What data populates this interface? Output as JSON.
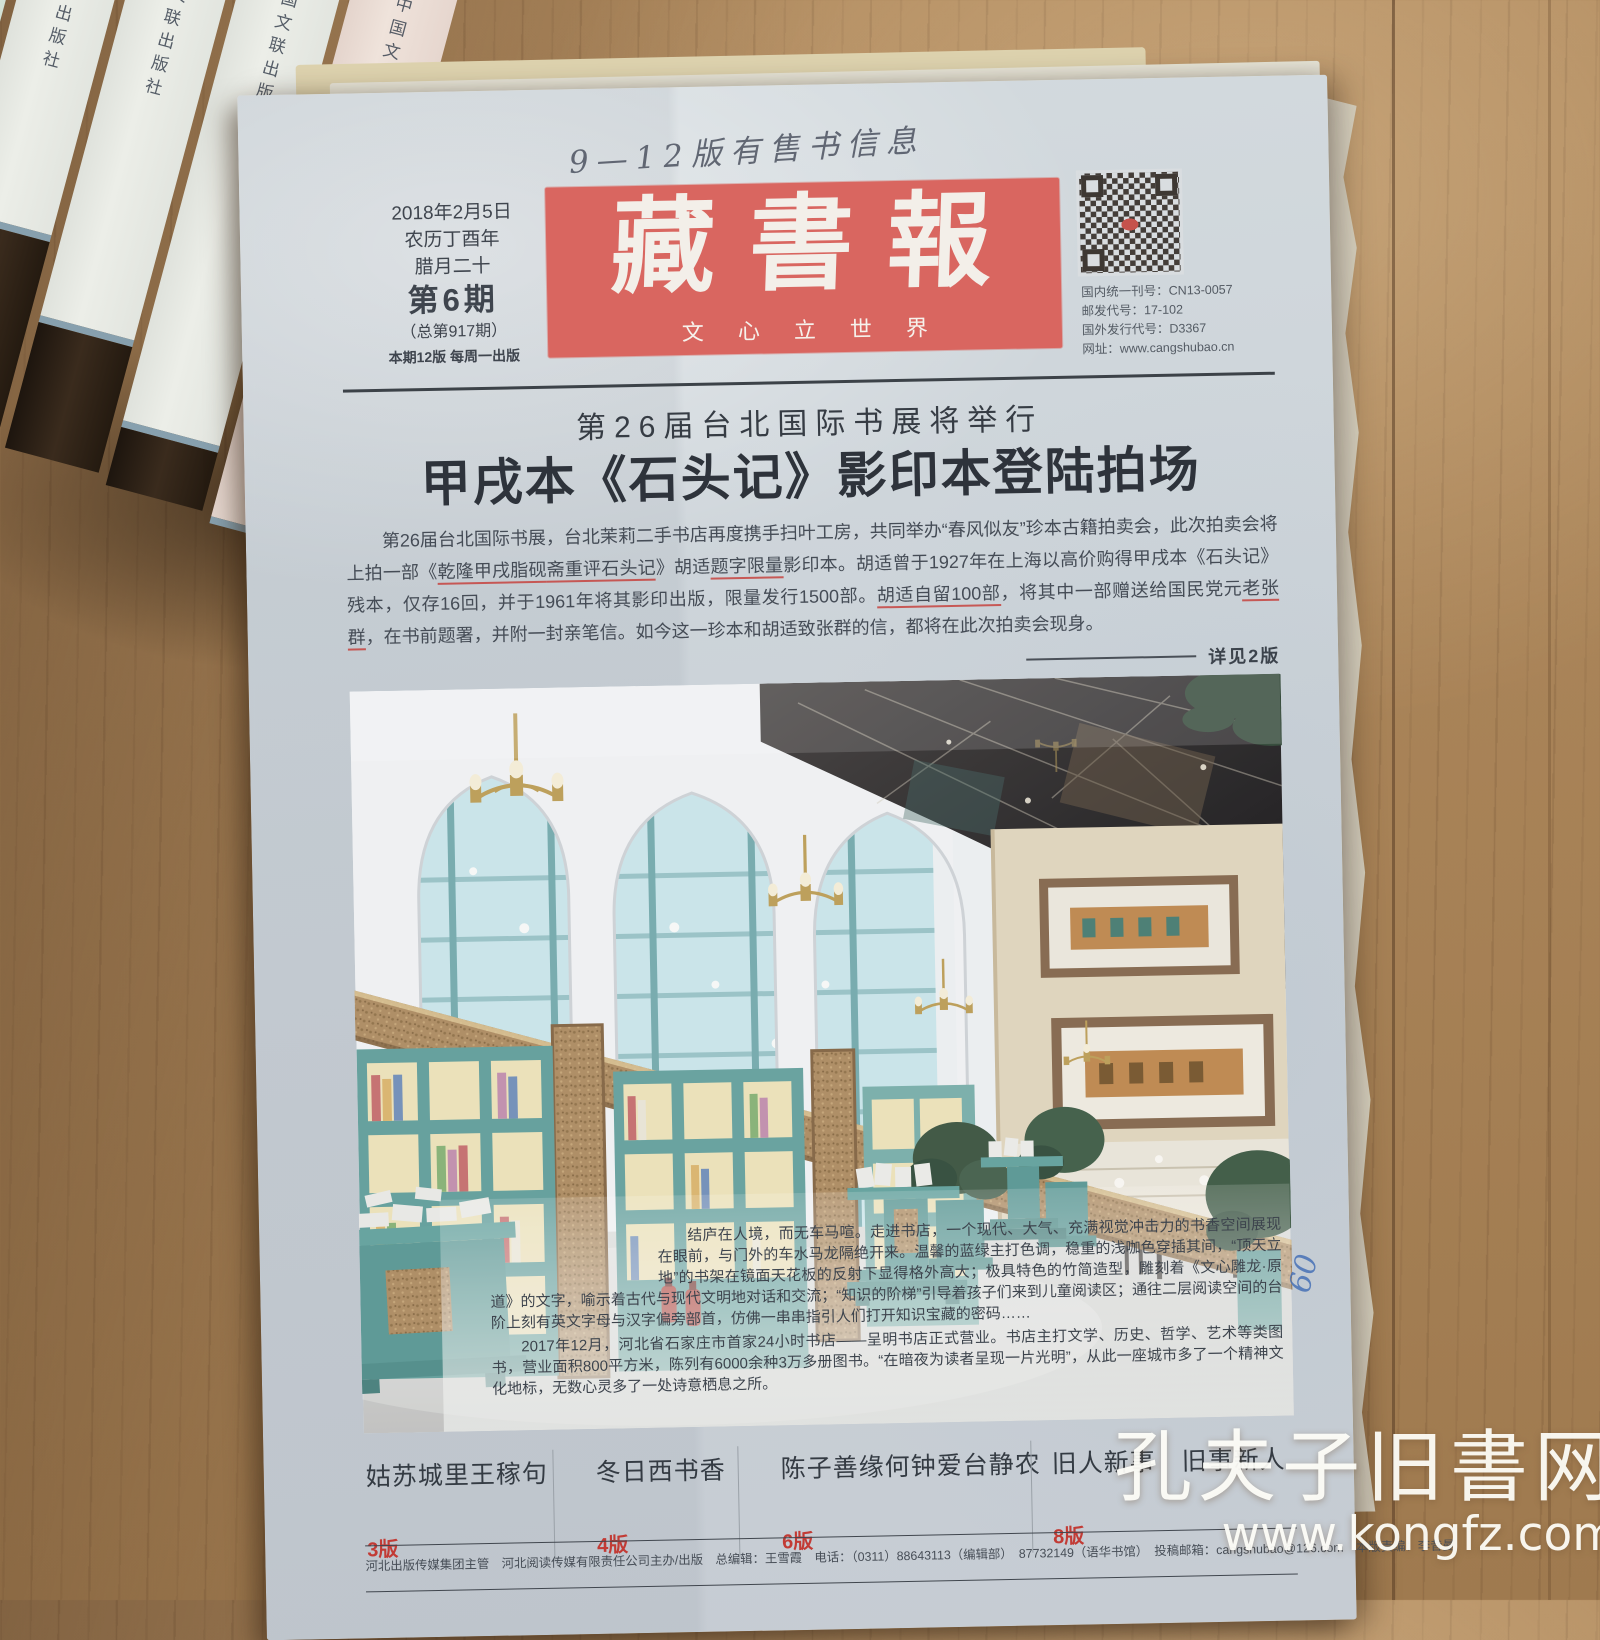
{
  "scene": {
    "hand_note": "9—12版有售书信息",
    "margin_note": "09",
    "book_spine_text": "中国文联出版社",
    "watermark": {
      "line1": "孔夫子旧書网",
      "line2": "www.kongfz.com"
    }
  },
  "masthead": {
    "title": "藏書報",
    "tagline": "文心立世界",
    "banner_color": "#d96660"
  },
  "issue_info": {
    "date": "2018年2月5日",
    "lunar_year": "农历丁酉年",
    "lunar_day": "腊月二十",
    "issue_no": "第6期",
    "total_issue": "（总第917期）",
    "pages_note": "本期12版  每周一出版"
  },
  "pub_codes": {
    "domestic": "国内统一刊号：CN13-0057",
    "postal": "邮发代号：17-102",
    "foreign": "国外发行代号：D3367",
    "website": "网址：www.cangshubao.cn"
  },
  "lead_story": {
    "kicker": "第26届台北国际书展将举行",
    "headline": "甲戌本《石头记》影印本登陆拍场",
    "body": "第26届台北国际书展，台北茉莉二手书店再度携手扫叶工房，共同举办“春风似友”珍本古籍拍卖会，此次拍卖会将上拍一部《乾隆甲戌脂砚斋重评石头记》胡适题字限量影印本。胡适曾于1927年在上海以高价购得甲戌本《石头记》残本，仅存16回，并于1961年将其影印出版，限量发行1500部。胡适自留100部，将其中一部赠送给国民党元老张群，在书前题署，并附一封亲笔信。如今这一珍本和胡适致张群的信，都将在此次拍卖会现身。",
    "red_marks": [
      "乾隆甲戌脂砚",
      "斋重评石头记",
      "题字限量",
      "胡适自留100部",
      "老张群"
    ],
    "see_more": "详见2版"
  },
  "photo_caption": {
    "para1": "结庐在人境，而无车马喧。走进书店，一个现代、大气、充满视觉冲击力的书香空间展现在眼前，与门外的车水马龙隔绝开来。温馨的蓝绿主打色调，稳重的浅咖色穿插其间，“顶天立地”的书架在镜面天花板的反射下显得格外高大；极具特色的竹简造型，雕刻着《文心雕龙·原道》的文字，喻示着古代与现代文明地对话和交流；“知识的阶梯”引导着孩子们来到儿童阅读区；通往二层阅读空间的台阶上刻有英文字母与汉字偏旁部首，仿佛一串串指引人们打开知识宝藏的密码……",
    "para2": "2017年12月，河北省石家庄市首家24小时书店——呈明书店正式营业。书店主打文学、历史、哲学、艺术等类图书，营业面积800平方米，陈列有6000余种3万多册图书。“在暗夜为读者呈现一片光明”，从此一座城市多了一个精神文化地标，无数心灵多了一处诗意栖息之所。"
  },
  "teasers": [
    {
      "title": "姑苏城里王稼句",
      "page": "3版"
    },
    {
      "title": "冬日西书香",
      "page": "4版"
    },
    {
      "title": "陈子善缘何钟爱台静农",
      "page": "6版"
    },
    {
      "title": "旧人新事　旧事新人",
      "page": "8版"
    }
  ],
  "footer": {
    "line": "河北出版传媒集团主管　河北阅读传媒有限责任公司主办/出版　总编辑：王雪霞　电话：（0311）88643113（编辑部）　87732149（语华书馆）　投稿邮箱：cangshubao@126.com　本版责编：李昔曼"
  },
  "colors": {
    "masthead_red": "#d96660",
    "accent_red": "#c23b35",
    "paper": "#cdd4da",
    "wood": "#ab865a"
  }
}
